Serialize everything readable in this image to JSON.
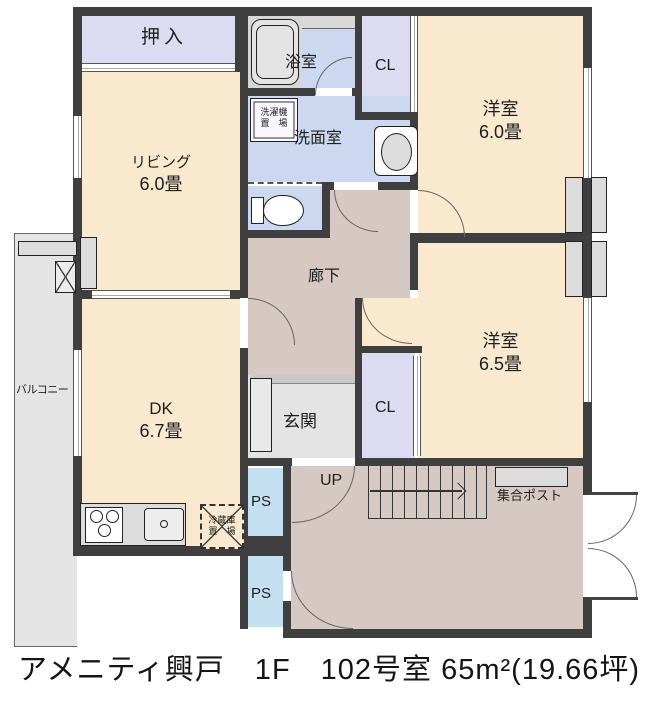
{
  "plan": {
    "rooms": {
      "oshiire": {
        "label": "押入"
      },
      "bathroom": {
        "label": "浴室"
      },
      "closet_top": {
        "label": "CL"
      },
      "western_room_1": {
        "label": "洋室",
        "size": "6.0畳"
      },
      "living": {
        "label": "リビング",
        "size": "6.0畳"
      },
      "washroom": {
        "label": "洗面室"
      },
      "hallway": {
        "label": "廊下"
      },
      "western_room_2": {
        "label": "洋室",
        "size": "6.5畳"
      },
      "dk": {
        "label": "DK",
        "size": "6.7畳"
      },
      "entrance": {
        "label": "玄関"
      },
      "closet_bottom": {
        "label": "CL"
      },
      "balcony": {
        "label": "バルコニー"
      },
      "ps_top": {
        "label": "PS"
      },
      "ps_bottom": {
        "label": "PS"
      },
      "stair_hall": {
        "up_label": "UP",
        "mailbox_label": "集合ポスト"
      }
    },
    "fixtures": {
      "washer_space": {
        "line1": "洗濯機",
        "line2": "置　場"
      },
      "fridge_space": {
        "line1": "冷蔵庫",
        "line2": "置　場"
      }
    },
    "colors": {
      "wall": "#3f3f3f",
      "room_cream": "#f9e9cf",
      "closet_lavender": "#dcdbf2",
      "wet_area_blue": "#ccd8f0",
      "ps_blue": "#c4dff0",
      "hallway_brown": "#d6c9c3",
      "floor_gray": "#e3e3e3"
    }
  },
  "caption": "アメニティ興戸　1F　102号室 65m²(19.66坪)"
}
